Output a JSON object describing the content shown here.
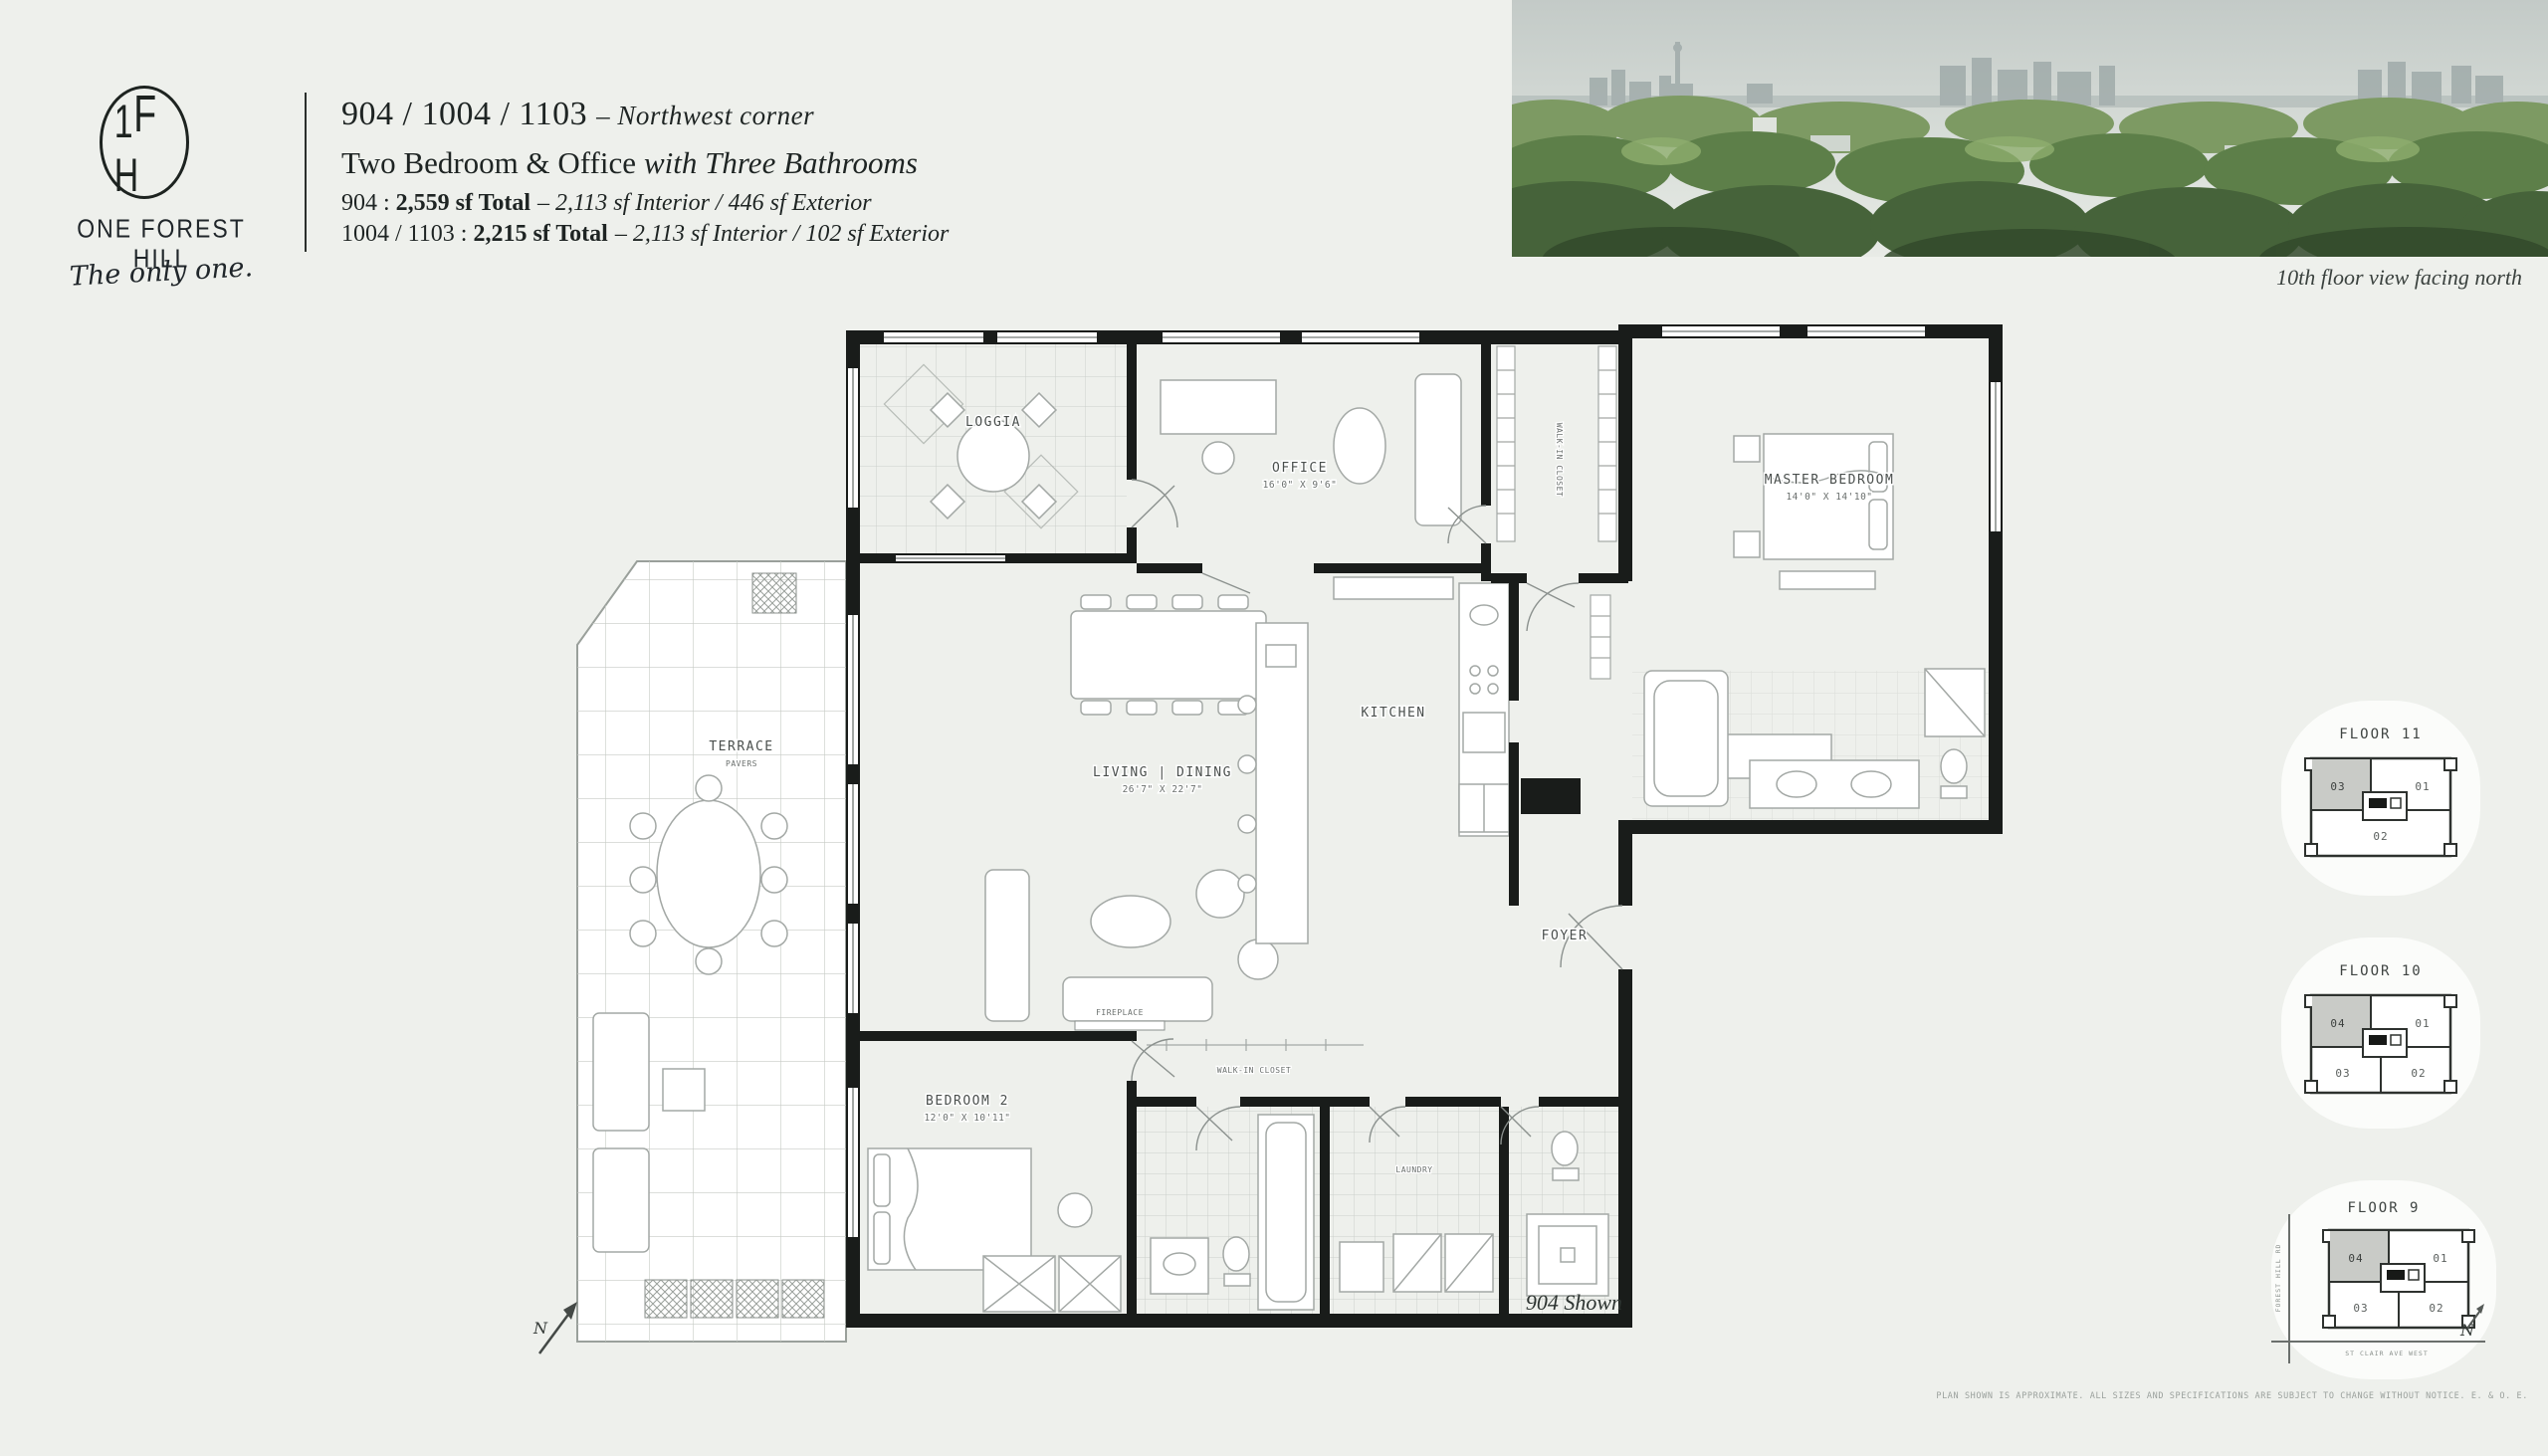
{
  "brand": {
    "m1": "1",
    "m2": "F",
    "m3": "H",
    "name": "ONE FOREST HILL",
    "tagline": "The only one."
  },
  "header": {
    "units": "904 / 1004 / 1103",
    "corner": "– Northwest corner",
    "type_main": "Two Bedroom & Office",
    "type_italic": "with Three Bathrooms",
    "l3_prefix": "904 :",
    "l3_bold": "2,559 sf Total",
    "l3_rest": "– 2,113 sf Interior / 446 sf Exterior",
    "l4_prefix": "1004 / 1103 :",
    "l4_bold": "2,215 sf Total",
    "l4_rest": "– 2,113 sf Interior / 102 sf Exterior"
  },
  "photo": {
    "caption": "10th floor view facing north"
  },
  "plan": {
    "rooms": {
      "loggia": {
        "label": "LOGGIA"
      },
      "office": {
        "label": "OFFICE",
        "dims": "16'0\" X 9'6\""
      },
      "master": {
        "label": "MASTER BEDROOM",
        "dims": "14'0\" X 14'10\""
      },
      "kitchen": {
        "label": "KITCHEN"
      },
      "living": {
        "label": "LIVING | DINING",
        "dims": "26'7\" X 22'7\""
      },
      "terrace": {
        "label": "TERRACE",
        "sublabel": "PAVERS"
      },
      "foyer": {
        "label": "FOYER"
      },
      "bedroom2": {
        "label": "BEDROOM 2",
        "dims": "12'0\" X 10'11\""
      },
      "walkin": {
        "label": "WALK-IN CLOSET"
      },
      "walkin2": {
        "label": "WALK-IN CLOSET"
      },
      "laundry": {
        "label": "LAUNDRY"
      },
      "fireplace": {
        "label": "FIREPLACE"
      }
    },
    "caption": "904 Shown",
    "north": "N"
  },
  "keyplans": [
    {
      "title": "FLOOR 11",
      "u01": "01",
      "u02": "02",
      "u03": "03"
    },
    {
      "title": "FLOOR 10",
      "u01": "01",
      "u02": "02",
      "u03": "03",
      "u04": "04"
    },
    {
      "title": "FLOOR 9",
      "u01": "01",
      "u02": "02",
      "u03": "03",
      "u04": "04",
      "street_left": "FOREST HILL RD",
      "street_bottom": "ST CLAIR AVE WEST",
      "north": "N"
    }
  ],
  "disclaimer": "PLAN SHOWN IS APPROXIMATE. ALL SIZES AND SPECIFICATIONS ARE SUBJECT TO CHANGE WITHOUT NOTICE. E. & O. E.",
  "colors": {
    "background": "#eef0ec",
    "wall": "#191c1a",
    "highlight_unit": "#c9cbc7",
    "ink": "#1e2423"
  }
}
